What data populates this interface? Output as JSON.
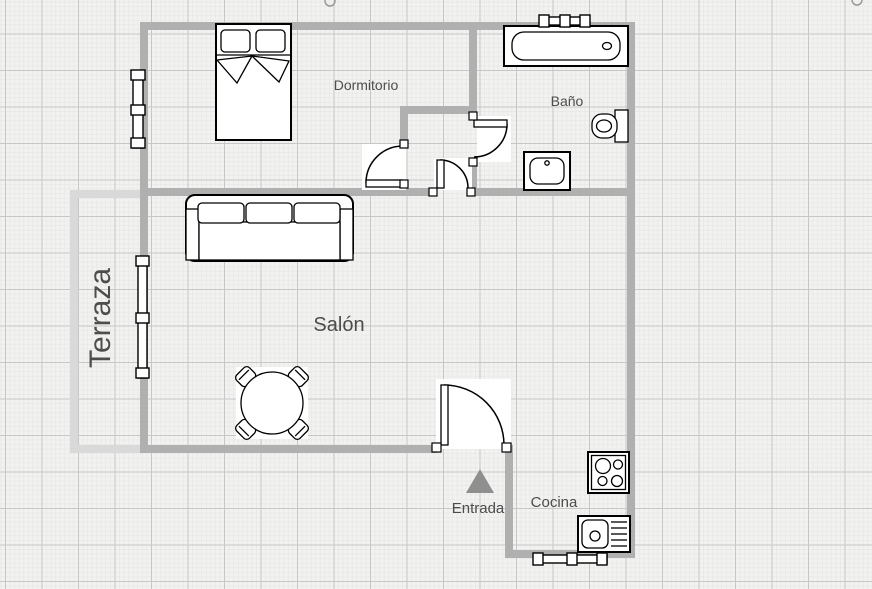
{
  "floor_plan": {
    "room_labels": {
      "dormitorio": "Dormitorio",
      "bano": "Baño",
      "salon": "Salón",
      "terraza": "Terraza",
      "entrada": "Entrada",
      "cocina": "Cocina"
    },
    "furniture": [
      "double-bed",
      "sofa-three-seat",
      "round-dining-table-with-four-chairs",
      "bathtub",
      "toilet",
      "bathroom-sink",
      "stove-cooktop",
      "kitchen-sink-with-drainboard"
    ],
    "fixtures": [
      "entrance-arrow",
      "window-bedroom-left-wall",
      "window-terrace-wall",
      "window-bathroom-top-wall",
      "window-kitchen-bottom-wall",
      "door-bedroom",
      "door-bathroom",
      "door-living-room",
      "door-entrance"
    ],
    "colors": {
      "wall": "#b0b0b0",
      "terrace_wall": "#d9d9d9",
      "canvas_background": "#f2f2f0",
      "grid_major": "#c7c7c7",
      "grid_minor": "#e9e9e7",
      "label_text": "#4d4d4d",
      "furniture_outline": "#000000",
      "entrance_arrow": "#8f8f8f"
    }
  }
}
